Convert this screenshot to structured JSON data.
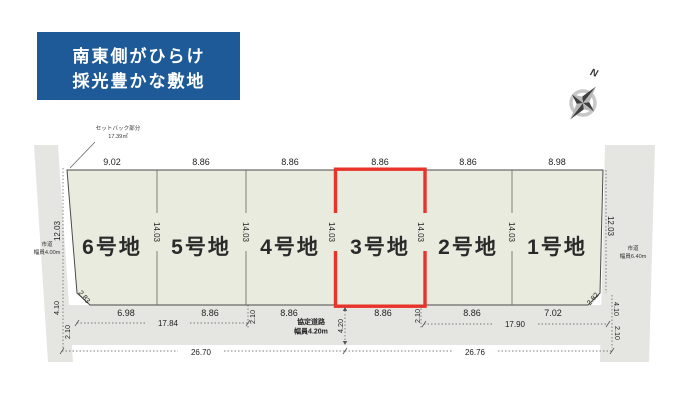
{
  "banner": {
    "line1": "南東側がひらけ",
    "line2": "採光豊かな敷地"
  },
  "compass": {
    "north_label": "N"
  },
  "annotations": {
    "setback_line1": "セットバック部分",
    "setback_line2": "17.39㎡",
    "road_left_line1": "市道",
    "road_left_line2": "幅員4.00m",
    "road_right_line1": "市道",
    "road_right_line2": "幅員6.40m",
    "road_bottom_line1": "協定道路",
    "road_bottom_line2": "幅員4.20m"
  },
  "lots": [
    {
      "label": "6号地"
    },
    {
      "label": "5号地"
    },
    {
      "label": "4号地"
    },
    {
      "label": "3号地"
    },
    {
      "label": "2号地"
    },
    {
      "label": "1号地"
    }
  ],
  "dimensions": {
    "top": [
      "9.02",
      "8.86",
      "8.86",
      "8.86",
      "8.86",
      "8.98"
    ],
    "bottom": [
      "6.98",
      "8.86",
      "8.86",
      "8.86",
      "8.86",
      "7.02"
    ],
    "depth": [
      "14.03",
      "14.03",
      "14.03",
      "14.03",
      "14.03"
    ],
    "left_side": "12.03",
    "right_side": "12.03",
    "left_offsets": [
      "4.10",
      "2.10"
    ],
    "right_offsets": [
      "4.10",
      "2.10"
    ],
    "corner_left": "2.83",
    "corner_right": "2.82",
    "mid_offsets": [
      "2.10",
      "2.10"
    ],
    "road_width_dim": "4.20",
    "span_left": "17.84",
    "span_right": "17.90",
    "total_left": "26.70",
    "total_right": "26.76"
  },
  "colors": {
    "banner_bg": "#1d5a97",
    "lot_fill": "#e8ebde",
    "road_fill": "#e5e5e2",
    "highlight": "#e8332a"
  }
}
